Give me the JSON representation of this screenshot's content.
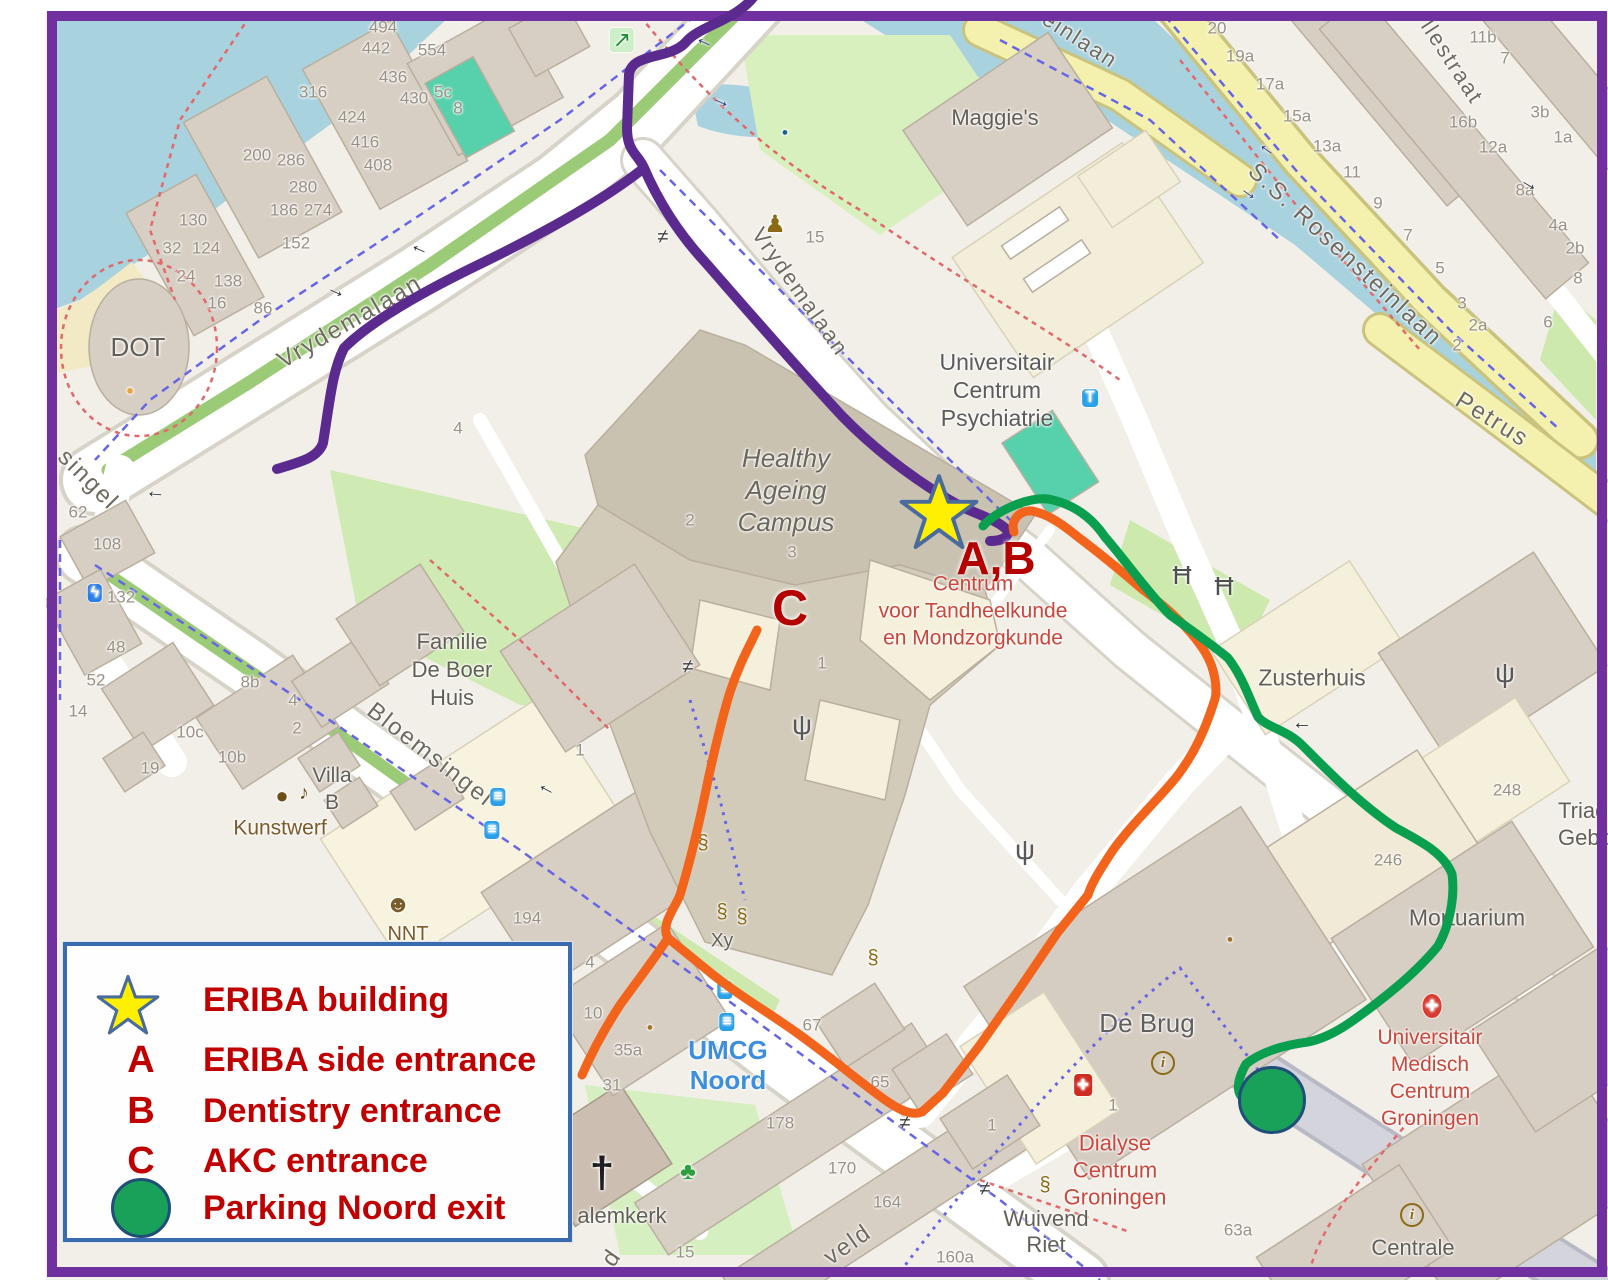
{
  "canvas": {
    "w": 1608,
    "h": 1280
  },
  "colors": {
    "frame": "#7030A0",
    "map_bg": "#F2EFE8",
    "water": "#A9D2DF",
    "legend_border": "#3A6BAE",
    "legend_text": "#C00000",
    "annotation_red": "#B50000",
    "star_fill": "#FFEF00",
    "star_stroke": "#4A6B9B",
    "parking_fill": "#19A15A",
    "parking_stroke": "#1F4E79"
  },
  "routes": {
    "purple": {
      "color": "#5B2A8F"
    },
    "orange": {
      "color": "#F2641C"
    },
    "green": {
      "color": "#0A9E4F"
    }
  },
  "legend": {
    "items": [
      {
        "symbol": "star",
        "label": "ERIBA building"
      },
      {
        "symbol": "A",
        "label": "ERIBA side entrance"
      },
      {
        "symbol": "B",
        "label": "Dentistry entrance"
      },
      {
        "symbol": "C",
        "label": "AKC entrance"
      },
      {
        "symbol": "circle",
        "label": "Parking Noord exit"
      }
    ]
  },
  "map": {
    "markers": {
      "eriba_star": {
        "x": 897,
        "y": 473,
        "size": 84
      },
      "parking_exit": {
        "x": 1272,
        "y": 1100,
        "r": 31
      }
    },
    "annotations": [
      {
        "t": "A,B",
        "x": 996,
        "y": 558,
        "s": 46
      },
      {
        "t": "C",
        "x": 790,
        "y": 608,
        "s": 50
      }
    ],
    "street_labels": [
      {
        "t": "Vrydemalaan",
        "x": 350,
        "y": 322,
        "rot": -30,
        "s": 24
      },
      {
        "t": "Vrydemalaan",
        "x": 800,
        "y": 292,
        "rot": 55,
        "s": 22
      },
      {
        "t": "Bloemsingel",
        "x": 430,
        "y": 755,
        "rot": 38,
        "s": 24
      },
      {
        "t": "S.S. Rosensteinlaan",
        "x": 1345,
        "y": 255,
        "rot": 43,
        "s": 24
      },
      {
        "t": "llestraat",
        "x": 1452,
        "y": 62,
        "rot": 57,
        "s": 22
      },
      {
        "t": "einlaan",
        "x": 1080,
        "y": 40,
        "rot": 33,
        "s": 22
      },
      {
        "t": "Petrus",
        "x": 1492,
        "y": 420,
        "rot": 32,
        "s": 24
      },
      {
        "t": "singel",
        "x": 88,
        "y": 480,
        "rot": 45,
        "s": 24
      },
      {
        "t": "veld",
        "x": 848,
        "y": 1245,
        "rot": -35,
        "s": 24
      },
      {
        "t": "d",
        "x": 612,
        "y": 1258,
        "rot": -55,
        "s": 24
      }
    ],
    "place_labels": [
      {
        "lines": [
          "Maggie's"
        ],
        "x": 995,
        "y": 118,
        "s": 22
      },
      {
        "lines": [
          "Universitair",
          "Centrum",
          "Psychiatrie"
        ],
        "x": 997,
        "y": 390,
        "s": 23,
        "lh": 28,
        "c": "#5B5B5B"
      },
      {
        "lines": [
          "Healthy",
          "Ageing",
          "Campus"
        ],
        "x": 786,
        "y": 490,
        "s": 26,
        "lh": 32,
        "c": "#6C675C",
        "italic": true
      },
      {
        "lines": [
          "Centrum",
          "voor Tandheelkunde",
          "en Mondzorgkunde"
        ],
        "x": 973,
        "y": 611,
        "s": 21,
        "lh": 27,
        "c": "#C9473C"
      },
      {
        "lines": [
          "Familie",
          "De Boer",
          "Huis"
        ],
        "x": 452,
        "y": 670,
        "s": 22,
        "lh": 28
      },
      {
        "lines": [
          "Zusterhuis"
        ],
        "x": 1312,
        "y": 678,
        "s": 23
      },
      {
        "lines": [
          "Villa",
          "B"
        ],
        "x": 332,
        "y": 789,
        "s": 21,
        "lh": 27
      },
      {
        "lines": [
          "Kunstwerf"
        ],
        "x": 280,
        "y": 828,
        "s": 21,
        "c": "#7A5B2B"
      },
      {
        "lines": [
          "NNT"
        ],
        "x": 408,
        "y": 934,
        "s": 20,
        "c": "#7A5B2B"
      },
      {
        "lines": [
          "UMCG",
          "Noord"
        ],
        "x": 728,
        "y": 1065,
        "s": 26,
        "lh": 30,
        "c": "#3E8EDE",
        "bold": true
      },
      {
        "lines": [
          "De Brug"
        ],
        "x": 1147,
        "y": 1023,
        "s": 26,
        "c": "#5F5F5F"
      },
      {
        "lines": [
          "Dialyse",
          "Centrum",
          "Groningen"
        ],
        "x": 1115,
        "y": 1170,
        "s": 22,
        "lh": 27,
        "c": "#C9473C"
      },
      {
        "lines": [
          "Wuivend",
          "Riet"
        ],
        "x": 1046,
        "y": 1232,
        "s": 22,
        "lh": 26
      },
      {
        "lines": [
          "Mortuarium"
        ],
        "x": 1467,
        "y": 918,
        "s": 23
      },
      {
        "lines": [
          "Triade",
          "Gebouw"
        ],
        "x": 1558,
        "y": 824,
        "s": 22,
        "lh": 27,
        "align": "left"
      },
      {
        "lines": [
          "Universitair",
          "Medisch",
          "Centrum",
          "Groningen"
        ],
        "x": 1430,
        "y": 1078,
        "s": 21,
        "lh": 27,
        "c": "#C9473C"
      },
      {
        "lines": [
          "Centrale"
        ],
        "x": 1413,
        "y": 1248,
        "s": 22
      },
      {
        "lines": [
          "alemkerk"
        ],
        "x": 622,
        "y": 1216,
        "s": 22
      },
      {
        "lines": [
          "DOT"
        ],
        "x": 138,
        "y": 347,
        "s": 26
      },
      {
        "lines": [
          "Xy"
        ],
        "x": 722,
        "y": 941,
        "s": 19
      }
    ],
    "house_numbers": [
      {
        "t": "494",
        "x": 383,
        "y": 27
      },
      {
        "t": "442",
        "x": 376,
        "y": 48
      },
      {
        "t": "554",
        "x": 432,
        "y": 50
      },
      {
        "t": "436",
        "x": 393,
        "y": 77
      },
      {
        "t": "430",
        "x": 414,
        "y": 98
      },
      {
        "t": "5c",
        "x": 443,
        "y": 92
      },
      {
        "t": "8",
        "x": 458,
        "y": 108
      },
      {
        "t": "316",
        "x": 313,
        "y": 92
      },
      {
        "t": "424",
        "x": 352,
        "y": 117
      },
      {
        "t": "416",
        "x": 365,
        "y": 142
      },
      {
        "t": "408",
        "x": 378,
        "y": 165
      },
      {
        "t": "200",
        "x": 257,
        "y": 155
      },
      {
        "t": "286",
        "x": 291,
        "y": 160
      },
      {
        "t": "280",
        "x": 303,
        "y": 187
      },
      {
        "t": "186",
        "x": 284,
        "y": 210
      },
      {
        "t": "274",
        "x": 318,
        "y": 210
      },
      {
        "t": "152",
        "x": 296,
        "y": 243
      },
      {
        "t": "130",
        "x": 193,
        "y": 220
      },
      {
        "t": "32",
        "x": 172,
        "y": 248
      },
      {
        "t": "124",
        "x": 206,
        "y": 248
      },
      {
        "t": "24",
        "x": 186,
        "y": 276
      },
      {
        "t": "138",
        "x": 228,
        "y": 281
      },
      {
        "t": "16",
        "x": 217,
        "y": 303
      },
      {
        "t": "86",
        "x": 263,
        "y": 308
      },
      {
        "t": "62",
        "x": 78,
        "y": 512
      },
      {
        "t": "108",
        "x": 107,
        "y": 544
      },
      {
        "t": "132",
        "x": 121,
        "y": 597
      },
      {
        "t": "48",
        "x": 116,
        "y": 647
      },
      {
        "t": "52",
        "x": 96,
        "y": 680
      },
      {
        "t": "14",
        "x": 78,
        "y": 711
      },
      {
        "t": "8b",
        "x": 250,
        "y": 682
      },
      {
        "t": "4",
        "x": 293,
        "y": 700
      },
      {
        "t": "2",
        "x": 297,
        "y": 728
      },
      {
        "t": "10c",
        "x": 190,
        "y": 732
      },
      {
        "t": "10b",
        "x": 232,
        "y": 757
      },
      {
        "t": "19",
        "x": 150,
        "y": 768
      },
      {
        "t": "194",
        "x": 527,
        "y": 918
      },
      {
        "t": "4",
        "x": 590,
        "y": 962
      },
      {
        "t": "10",
        "x": 593,
        "y": 1013
      },
      {
        "t": "35a",
        "x": 628,
        "y": 1050
      },
      {
        "t": "31",
        "x": 612,
        "y": 1085
      },
      {
        "t": "178",
        "x": 780,
        "y": 1123
      },
      {
        "t": "170",
        "x": 842,
        "y": 1168
      },
      {
        "t": "164",
        "x": 887,
        "y": 1202
      },
      {
        "t": "15",
        "x": 685,
        "y": 1252
      },
      {
        "t": "160a",
        "x": 955,
        "y": 1257
      },
      {
        "t": "67",
        "x": 812,
        "y": 1025
      },
      {
        "t": "65",
        "x": 880,
        "y": 1082
      },
      {
        "t": "1",
        "x": 992,
        "y": 1125
      },
      {
        "t": "1",
        "x": 1113,
        "y": 1105
      },
      {
        "t": "63a",
        "x": 1238,
        "y": 1230
      },
      {
        "t": "246",
        "x": 1388,
        "y": 860
      },
      {
        "t": "248",
        "x": 1507,
        "y": 790
      },
      {
        "t": "1",
        "x": 822,
        "y": 663
      },
      {
        "t": "2",
        "x": 690,
        "y": 520
      },
      {
        "t": "3",
        "x": 792,
        "y": 552
      },
      {
        "t": "4",
        "x": 458,
        "y": 428
      },
      {
        "t": "15",
        "x": 815,
        "y": 237
      },
      {
        "t": "1",
        "x": 580,
        "y": 750
      },
      {
        "t": "20",
        "x": 1217,
        "y": 28
      },
      {
        "t": "19a",
        "x": 1240,
        "y": 56
      },
      {
        "t": "17a",
        "x": 1270,
        "y": 84
      },
      {
        "t": "15a",
        "x": 1297,
        "y": 116
      },
      {
        "t": "13a",
        "x": 1327,
        "y": 146
      },
      {
        "t": "11",
        "x": 1352,
        "y": 172
      },
      {
        "t": "9",
        "x": 1378,
        "y": 203
      },
      {
        "t": "7",
        "x": 1408,
        "y": 235
      },
      {
        "t": "5",
        "x": 1440,
        "y": 268
      },
      {
        "t": "3",
        "x": 1462,
        "y": 303
      },
      {
        "t": "2a",
        "x": 1478,
        "y": 325
      },
      {
        "t": "11b",
        "x": 1483,
        "y": 37
      },
      {
        "t": "7",
        "x": 1505,
        "y": 58
      },
      {
        "t": "16b",
        "x": 1463,
        "y": 122
      },
      {
        "t": "12a",
        "x": 1493,
        "y": 147
      },
      {
        "t": "3b",
        "x": 1540,
        "y": 112
      },
      {
        "t": "1a",
        "x": 1563,
        "y": 137
      },
      {
        "t": "8a",
        "x": 1525,
        "y": 190
      },
      {
        "t": "4a",
        "x": 1558,
        "y": 225
      },
      {
        "t": "2b",
        "x": 1575,
        "y": 248
      },
      {
        "t": "8",
        "x": 1578,
        "y": 278
      },
      {
        "t": "6",
        "x": 1548,
        "y": 322
      },
      {
        "t": "2",
        "x": 1457,
        "y": 345
      }
    ],
    "icons": [
      {
        "n": "emergency-exit-icon",
        "k": "badge",
        "g": "↗",
        "x": 622,
        "y": 40,
        "c": "#1F8A3A",
        "bg": "#CDEFC7",
        "s": 22
      },
      {
        "n": "statue-icon",
        "k": "plain",
        "g": "♟",
        "x": 775,
        "y": 225,
        "c": "#8A6A14",
        "s": 24
      },
      {
        "n": "gate-icon",
        "k": "plain",
        "g": "≠",
        "x": 663,
        "y": 237,
        "c": "#3F3F3F",
        "s": 20
      },
      {
        "n": "gate-icon",
        "k": "plain",
        "g": "≠",
        "x": 688,
        "y": 667,
        "c": "#3F3F3F",
        "s": 20
      },
      {
        "n": "gate-icon",
        "k": "plain",
        "g": "≠",
        "x": 905,
        "y": 1123,
        "c": "#3F3F3F",
        "s": 20
      },
      {
        "n": "gate-icon",
        "k": "plain",
        "g": "≠",
        "x": 985,
        "y": 1189,
        "c": "#3F3F3F",
        "s": 20
      },
      {
        "n": "antenna-icon",
        "k": "plain",
        "g": "ψ",
        "x": 802,
        "y": 725,
        "c": "#585858",
        "s": 28
      },
      {
        "n": "antenna-icon",
        "k": "plain",
        "g": "ψ",
        "x": 1025,
        "y": 850,
        "c": "#585858",
        "s": 28
      },
      {
        "n": "antenna-icon",
        "k": "plain",
        "g": "ψ",
        "x": 1505,
        "y": 673,
        "c": "#585858",
        "s": 28
      },
      {
        "n": "picnic-table-icon",
        "k": "plain",
        "g": "Ħ",
        "x": 1182,
        "y": 575,
        "c": "#4F4F4F",
        "s": 26
      },
      {
        "n": "picnic-table-icon",
        "k": "plain",
        "g": "Ħ",
        "x": 1224,
        "y": 586,
        "c": "#4F4F4F",
        "s": 26
      },
      {
        "n": "taxi-icon",
        "k": "badge",
        "g": "T",
        "x": 1090,
        "y": 398,
        "c": "#FFFFFF",
        "bg": "#2AA0E8",
        "s": 16
      },
      {
        "n": "bus-stop-icon",
        "k": "badge",
        "g": "≡",
        "x": 498,
        "y": 797,
        "c": "#FFFFFF",
        "bg": "#2AA0E8",
        "s": 16
      },
      {
        "n": "bus-stop-icon",
        "k": "badge",
        "g": "≡",
        "x": 492,
        "y": 830,
        "c": "#FFFFFF",
        "bg": "#2AA0E8",
        "s": 16
      },
      {
        "n": "bus-stop-icon",
        "k": "badge",
        "g": "≡",
        "x": 725,
        "y": 990,
        "c": "#FFFFFF",
        "bg": "#2AA0E8",
        "s": 16
      },
      {
        "n": "bus-stop-icon",
        "k": "badge",
        "g": "≡",
        "x": 727,
        "y": 1022,
        "c": "#FFFFFF",
        "bg": "#2AA0E8",
        "s": 16
      },
      {
        "n": "charging-station-icon",
        "k": "badge",
        "g": "ϟ",
        "x": 95,
        "y": 593,
        "c": "#FFFFFF",
        "bg": "#2A7DE8",
        "s": 16
      },
      {
        "n": "art-palette-icon",
        "k": "plain",
        "g": "●",
        "x": 282,
        "y": 796,
        "c": "#6B4F17",
        "s": 22
      },
      {
        "n": "music-note-icon",
        "k": "plain",
        "g": "♪",
        "x": 304,
        "y": 793,
        "c": "#6B4F17",
        "s": 20
      },
      {
        "n": "theater-masks-icon",
        "k": "plain",
        "g": "☻",
        "x": 398,
        "y": 905,
        "c": "#7A5B2B",
        "s": 24
      },
      {
        "n": "church-cross-icon",
        "k": "plain",
        "g": "†",
        "x": 602,
        "y": 1173,
        "c": "#1E1E1E",
        "s": 44,
        "bold": true
      },
      {
        "n": "playground-icon",
        "k": "plain",
        "g": "♣",
        "x": 688,
        "y": 1172,
        "c": "#2E9E3E",
        "s": 24
      },
      {
        "n": "info-icon",
        "k": "round",
        "g": "i",
        "x": 1163,
        "y": 1063,
        "c": "#8A6A14",
        "s": 15
      },
      {
        "n": "info-icon",
        "k": "round",
        "g": "i",
        "x": 1412,
        "y": 1215,
        "c": "#8A6A14",
        "s": 15
      },
      {
        "n": "first-aid-icon",
        "k": "badge",
        "g": "+",
        "x": 1083,
        "y": 1085,
        "c": "#FFFFFF",
        "bg": "#CE2C22",
        "s": 20,
        "bold": true
      },
      {
        "n": "hospital-icon",
        "k": "badge",
        "g": "+",
        "x": 1432,
        "y": 1006,
        "c": "#FFFFFF",
        "bg": "#D83C31",
        "s": 22,
        "rd": true,
        "bold": true
      },
      {
        "n": "bollard-icon",
        "k": "plain",
        "g": "§",
        "x": 703,
        "y": 843,
        "c": "#8A6A14",
        "s": 20
      },
      {
        "n": "bollard-icon",
        "k": "plain",
        "g": "§",
        "x": 722,
        "y": 912,
        "c": "#8A6A14",
        "s": 20
      },
      {
        "n": "bollard-icon",
        "k": "plain",
        "g": "§",
        "x": 742,
        "y": 917,
        "c": "#8A6A14",
        "s": 20
      },
      {
        "n": "bollard-icon",
        "k": "plain",
        "g": "§",
        "x": 873,
        "y": 958,
        "c": "#8A6A14",
        "s": 20
      },
      {
        "n": "bollard-icon",
        "k": "plain",
        "g": "§",
        "x": 1045,
        "y": 1185,
        "c": "#8A6A14",
        "s": 20
      },
      {
        "n": "oneway-arrow-icon",
        "k": "plain",
        "g": "→",
        "x": 703,
        "y": 45,
        "c": "#26338B",
        "s": 20,
        "rot": 205
      },
      {
        "n": "oneway-arrow-icon",
        "k": "plain",
        "g": "→",
        "x": 722,
        "y": 100,
        "c": "#26338B",
        "s": 20,
        "rot": 25
      },
      {
        "n": "oneway-arrow-icon",
        "k": "plain",
        "g": "→",
        "x": 418,
        "y": 252,
        "c": "#2F2F2F",
        "s": 20,
        "rot": 205
      },
      {
        "n": "oneway-arrow-icon",
        "k": "plain",
        "g": "→",
        "x": 337,
        "y": 290,
        "c": "#2F2F2F",
        "s": 20,
        "rot": 25
      },
      {
        "n": "oneway-arrow-icon",
        "k": "plain",
        "g": "→",
        "x": 155,
        "y": 497,
        "c": "#2F2F2F",
        "s": 20,
        "rot": 185
      },
      {
        "n": "oneway-arrow-icon",
        "k": "plain",
        "g": "→",
        "x": 545,
        "y": 792,
        "c": "#2F2F2F",
        "s": 20,
        "rot": 208
      },
      {
        "n": "oneway-arrow-icon",
        "k": "plain",
        "g": "→",
        "x": 1302,
        "y": 728,
        "c": "#2F2F2F",
        "s": 20,
        "rot": 180
      },
      {
        "n": "oneway-arrow-icon",
        "k": "plain",
        "g": "→",
        "x": 1265,
        "y": 152,
        "c": "#26338B",
        "s": 20,
        "rot": 215
      },
      {
        "n": "oneway-arrow-icon",
        "k": "plain",
        "g": "→",
        "x": 1250,
        "y": 192,
        "c": "#26338B",
        "s": 20,
        "rot": 35
      },
      {
        "n": "oneway-arrow-icon",
        "k": "plain",
        "g": "→",
        "x": 1530,
        "y": 183,
        "c": "#2F2F2F",
        "s": 20,
        "rot": 30
      },
      {
        "n": "poi-dot-icon",
        "k": "plain",
        "g": "●",
        "x": 785,
        "y": 133,
        "c": "#1B5E8C",
        "s": 11
      },
      {
        "n": "poi-dot-icon",
        "k": "plain",
        "g": "●",
        "x": 130,
        "y": 390,
        "c": "#E8A33D",
        "s": 13
      },
      {
        "n": "poi-dot-icon",
        "k": "plain",
        "g": "●",
        "x": 650,
        "y": 1028,
        "c": "#A0722B",
        "s": 11
      },
      {
        "n": "poi-dot-icon",
        "k": "plain",
        "g": "●",
        "x": 1230,
        "y": 940,
        "c": "#A0722B",
        "s": 11
      }
    ]
  }
}
